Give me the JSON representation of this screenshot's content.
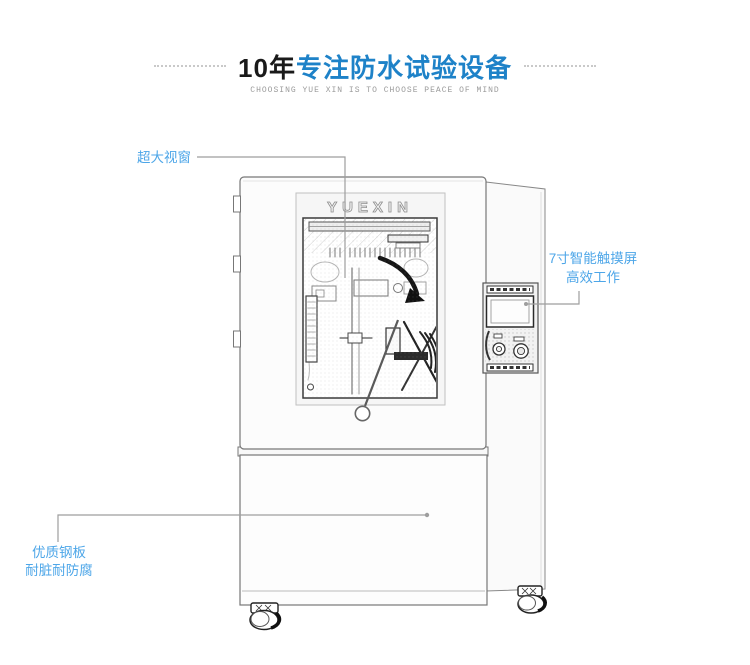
{
  "header": {
    "title_prefix": "10年",
    "title_main": "专注防水试验设备",
    "subtitle": "CHOOSING YUE XIN IS TO CHOOSE PEACE OF MIND",
    "title_accent_color": "#1e82c8"
  },
  "machine": {
    "brand_logo": "YUEXIN"
  },
  "callouts": {
    "label_color": "#4da6e8",
    "line_color": "#9e9e9e",
    "window": {
      "label": "超大视窗"
    },
    "touchscreen": {
      "line1": "7寸智能触摸屏",
      "line2": "高效工作"
    },
    "steel_plate": {
      "line1": "优质钢板",
      "line2": "耐脏耐防腐"
    }
  }
}
